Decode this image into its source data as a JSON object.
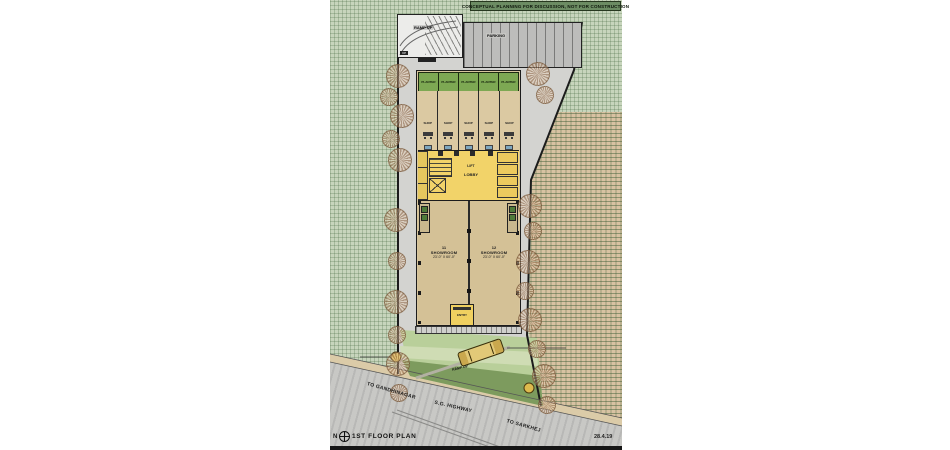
{
  "banner": {
    "text": "CONCEPTUAL PLANNING FOR DISCUSSION, NOT FOR CONSTRUCTION"
  },
  "site": {
    "ramp": {
      "label": "RAMP UP",
      "tag": "UP"
    },
    "parking": {
      "label": "PARKING"
    },
    "planters": [
      {
        "label": "PLANTER"
      },
      {
        "label": "PLANTER"
      },
      {
        "label": "PLANTER"
      },
      {
        "label": "PLANTER"
      },
      {
        "label": "PLANTER"
      }
    ],
    "shops": [
      {
        "label": "SHOP"
      },
      {
        "label": "SHOP"
      },
      {
        "label": "SHOP"
      },
      {
        "label": "SHOP"
      },
      {
        "label": "SHOP"
      }
    ],
    "core": {
      "line1": "LIFT",
      "line2": "LOBBY"
    },
    "showrooms": [
      {
        "number": "11",
        "name": "SHOWROOM",
        "size": "23'-0\" X 60'-0\""
      },
      {
        "number": "12",
        "name": "SHOWROOM",
        "size": "23'-0\" X 60'-0\""
      }
    ],
    "entry": {
      "label": "ENTRY"
    },
    "car": {
      "label": "RAMP UP"
    }
  },
  "roads": {
    "gandhinagar": "TO GANDHINAGAR",
    "highway": "S.G. HIGHWAY",
    "sarkhej": "TO SARKHEJ"
  },
  "footer": {
    "north": "N",
    "plan_title": "1ST  FLOOR  PLAN",
    "date": "28.4.19"
  },
  "colors": {
    "sheet_green": "#c7d5bc",
    "neighbor_tan": "#d8c2a2",
    "plot_grey": "#d3d3d0",
    "building_tan": "#d8c69e",
    "core_yellow": "#f2d369",
    "planter_green": "#7da853",
    "lawn_dark": "#7d9b5e",
    "lawn_light": "#b9cf9a",
    "road_grey": "#c8c8c5",
    "banner_green": "#6c8c63"
  }
}
